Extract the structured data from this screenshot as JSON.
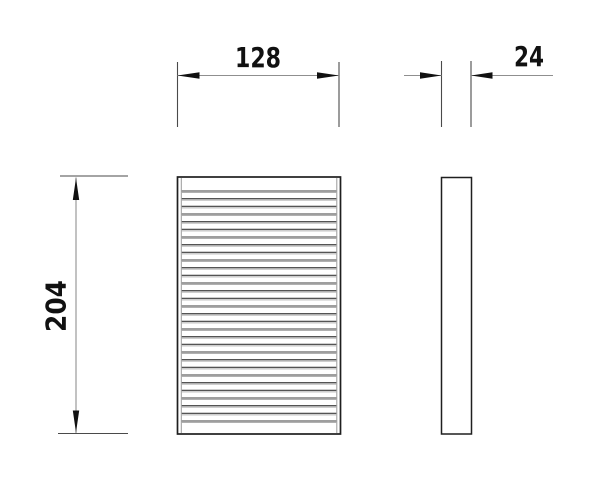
{
  "drawing": {
    "dimension_labels": {
      "width": "128",
      "depth": "24",
      "height": "204"
    },
    "front_view": {
      "pleat_count": 31
    },
    "colors": {
      "background": "#ffffff",
      "object_outline": "#1f1f1f",
      "frame_inner_line": "#9a9a9a",
      "extension_line": "#4a4a4a",
      "dimension_line": "#8f8f8f",
      "arrowhead": "#111111",
      "label_text": "#111111",
      "pleat_dark": "#3c3c3c",
      "pleat_light": "#b0b0b0"
    }
  }
}
